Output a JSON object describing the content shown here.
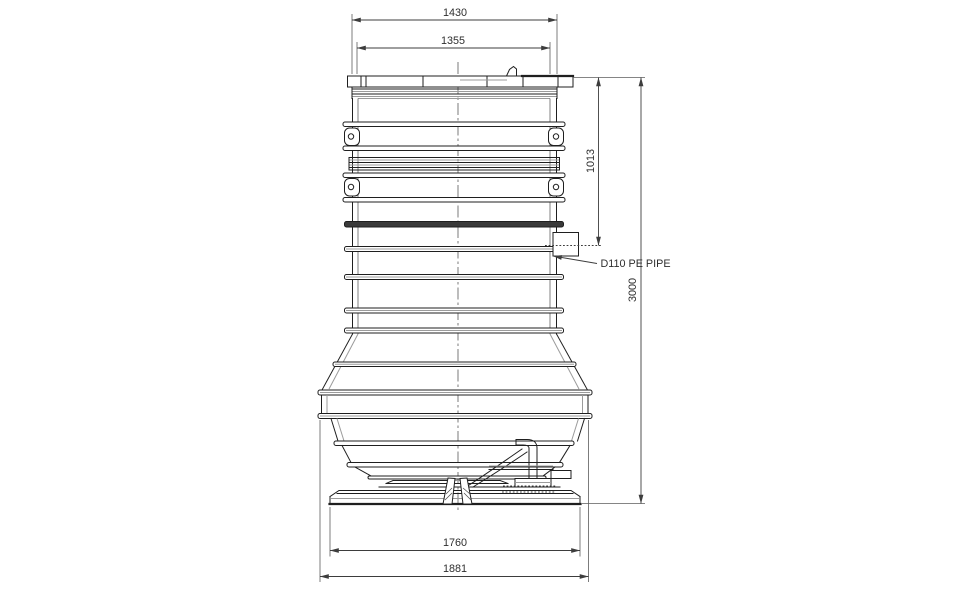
{
  "page": {
    "background": "#ffffff",
    "ink_color": "#1f1f1f",
    "secondary_line_color": "#9b9b9b",
    "subject": "pump-station-tank-elevation-drawing"
  },
  "drawing": {
    "dimensions": {
      "top_outer": "1430",
      "top_inner": "1355",
      "inlet_drop": "1013",
      "overall_height": "3000",
      "base_plate": "1760",
      "base_overall": "1881"
    },
    "annotations": {
      "inlet_pipe_label": "D110 PE PIPE"
    }
  }
}
